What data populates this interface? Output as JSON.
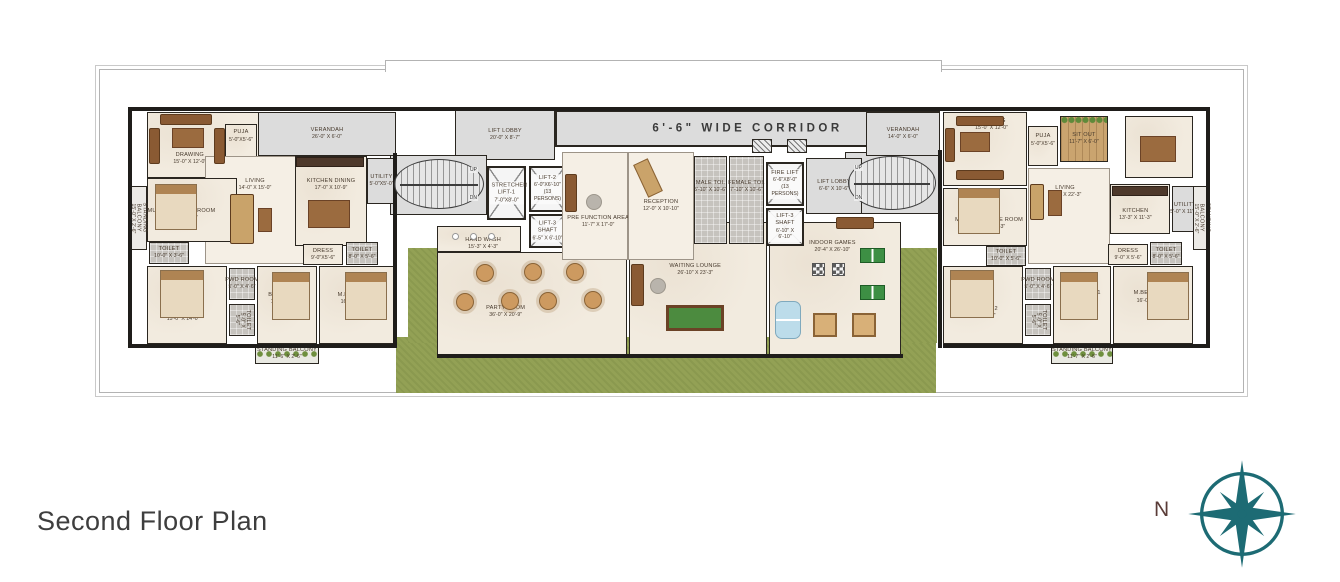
{
  "title": "Second Floor Plan",
  "compass": {
    "north_label": "N",
    "color": "#1d6b74"
  },
  "stairs": {
    "up_label": "UP",
    "dn_label": "DN"
  },
  "colors": {
    "wall": "#1f1d1a",
    "lawn": "#93a155",
    "corridor_gray": "#dcdcdc",
    "floor_beige": "#f2ebdf",
    "compass_teal": "#1d6b74"
  },
  "rooms": [
    {
      "id": "lawn-bottom",
      "x": 396,
      "y": 337,
      "w": 540,
      "h": 56,
      "cls": "lawn"
    },
    {
      "id": "lawn-left",
      "x": 408,
      "y": 248,
      "w": 32,
      "h": 95,
      "cls": "lawn"
    },
    {
      "id": "lawn-right",
      "x": 899,
      "y": 248,
      "w": 38,
      "h": 95,
      "cls": "lawn"
    },
    {
      "id": "party-room",
      "name": "PARTY ROOM",
      "dims": "36'-0\" X 20'-9\"",
      "x": 437,
      "y": 252,
      "w": 190,
      "h": 105,
      "cls": "unit",
      "lpos": [
        36,
        57
      ]
    },
    {
      "id": "waiting-lounge",
      "name": "WAITING LOUNGE",
      "dims": "26'-10\" X 23'-3\"",
      "x": 629,
      "y": 222,
      "w": 138,
      "h": 135,
      "cls": "unit",
      "lpos": [
        48,
        35
      ]
    },
    {
      "id": "indoor-games",
      "name": "INDOOR GAMES",
      "dims": "20'-4\" X 26'-10\"",
      "x": 769,
      "y": 222,
      "w": 132,
      "h": 135,
      "cls": "unit",
      "lpos": [
        48,
        18
      ]
    },
    {
      "id": "corridor",
      "name": "6'-6\" WIDE CORRIDOR",
      "x": 555,
      "y": 110,
      "w": 385,
      "h": 37,
      "cls": "gray corridor"
    },
    {
      "id": "lift-lobby-left",
      "name": "LIFT LOBBY",
      "dims": "20'-0\" X 8'-7\"",
      "x": 455,
      "y": 110,
      "w": 100,
      "h": 50,
      "cls": "gray"
    },
    {
      "id": "stair-zone-left",
      "x": 390,
      "y": 155,
      "w": 97,
      "h": 60,
      "cls": "gray"
    },
    {
      "id": "stair-zone-right",
      "x": 845,
      "y": 152,
      "w": 95,
      "h": 62,
      "cls": "gray"
    },
    {
      "id": "verandah-left",
      "name": "VERANDAH",
      "dims": "26'-0\" X 6'-0\"",
      "x": 258,
      "y": 112,
      "w": 138,
      "h": 44,
      "cls": "gray"
    },
    {
      "id": "verandah-right",
      "name": "VERANDAH",
      "dims": "14'-0\" X 6'-0\"",
      "x": 866,
      "y": 112,
      "w": 74,
      "h": 44,
      "cls": "gray"
    },
    {
      "id": "drawing-left",
      "name": "DRAWING",
      "dims": "15'-0\" X 12'-0\"",
      "x": 147,
      "y": 112,
      "w": 112,
      "h": 66,
      "cls": "unit",
      "lpos": [
        38,
        72
      ]
    },
    {
      "id": "puja-left",
      "name": "PUJA",
      "dims": "5'-0\"X5'-6\"",
      "x": 225,
      "y": 124,
      "w": 32,
      "h": 40,
      "cls": "unit",
      "lpos": [
        50,
        30
      ]
    },
    {
      "id": "living-left",
      "name": "LIVING",
      "dims": "14'-0\" X 15'-0\"",
      "x": 205,
      "y": 156,
      "w": 100,
      "h": 108,
      "cls": "open",
      "lpos": [
        50,
        26
      ]
    },
    {
      "id": "kitchen-dining-left",
      "name": "KITCHEN DINING",
      "dims": "17'-0\" X 10'-9\"",
      "x": 295,
      "y": 156,
      "w": 72,
      "h": 90,
      "cls": "unit",
      "lpos": [
        50,
        32
      ]
    },
    {
      "id": "utility-left",
      "name": "UTILITY",
      "dims": "5'-0\"X5'-0\"",
      "x": 367,
      "y": 158,
      "w": 29,
      "h": 46,
      "cls": "gray"
    },
    {
      "id": "multi-purpose-left",
      "name": "MULTI PURPOSE ROOM",
      "dims": "15'-0\" X 11'-3\"",
      "x": 147,
      "y": 178,
      "w": 90,
      "h": 64,
      "cls": "unit",
      "lpos": [
        38,
        58
      ]
    },
    {
      "id": "standing-balcony-left",
      "name": "STANDING BALCONY",
      "dims": "15'-0\" X 2'-6\"",
      "x": 130,
      "y": 186,
      "w": 17,
      "h": 64,
      "cls": "balcony",
      "vert": true
    },
    {
      "id": "toilet-left-1",
      "name": "TOILET",
      "dims": "10'-0\" X 3'-6\"",
      "x": 149,
      "y": 242,
      "w": 40,
      "h": 22,
      "cls": "tile"
    },
    {
      "id": "dress-left",
      "name": "DRESS",
      "dims": "9'-0\"X5'-6\"",
      "x": 303,
      "y": 244,
      "w": 40,
      "h": 21,
      "cls": "unit"
    },
    {
      "id": "toilet-left-2",
      "name": "TOILET",
      "dims": "8'-0\" X 5'-6\"",
      "x": 346,
      "y": 242,
      "w": 32,
      "h": 23,
      "cls": "tile"
    },
    {
      "id": "bed-room-2-left",
      "name": "BED ROOM-2",
      "dims": "15'-0\" X 14'-0\"",
      "x": 147,
      "y": 266,
      "w": 80,
      "h": 78,
      "cls": "unit",
      "lpos": [
        45,
        64
      ]
    },
    {
      "id": "pwd-room-left",
      "name": "PWD ROOM",
      "dims": "5'-0\" X 4'-6\"",
      "x": 229,
      "y": 268,
      "w": 26,
      "h": 32,
      "cls": "tile"
    },
    {
      "id": "toilet-left-3",
      "name": "TOILET",
      "dims": "5'-0\" X 5'-6\"",
      "x": 229,
      "y": 304,
      "w": 26,
      "h": 32,
      "cls": "tile",
      "vert": true
    },
    {
      "id": "bed-room-1-left",
      "name": "BED ROOM-1",
      "dims": "11'-0\" X 14'-0\"",
      "x": 257,
      "y": 266,
      "w": 60,
      "h": 78,
      "cls": "unit",
      "lpos": [
        50,
        42
      ]
    },
    {
      "id": "m-bed-room-left",
      "name": "M.BED ROOM",
      "dims": "16'-0\" X 14'-0\"",
      "x": 319,
      "y": 266,
      "w": 76,
      "h": 78,
      "cls": "unit",
      "lpos": [
        50,
        42
      ]
    },
    {
      "id": "standing-balcony-left-b",
      "name": "STANDING BALCONY",
      "dims": "11'-6\" X 2'-6\"",
      "x": 255,
      "y": 344,
      "w": 64,
      "h": 20,
      "cls": "planter"
    },
    {
      "id": "stretcher-lift-1",
      "name": "STRETCHER LIFT-1",
      "dims": "7'-0\"X8'-0\"",
      "x": 487,
      "y": 166,
      "w": 39,
      "h": 54,
      "cls": "lift"
    },
    {
      "id": "lift-2",
      "name": "LIFT-2",
      "dims": "6'-0\"X6'-10\" (13 PERSONS)",
      "x": 529,
      "y": 166,
      "w": 37,
      "h": 46,
      "cls": "lift"
    },
    {
      "id": "lift-3-shaft-center",
      "name": "LIFT-3 SHAFT",
      "dims": "6'-5\" X 6'-10\"",
      "x": 529,
      "y": 214,
      "w": 37,
      "h": 34,
      "cls": "lift"
    },
    {
      "id": "hand-wash",
      "name": "HAND WASH",
      "dims": "15'-3\" X 4'-3\"",
      "x": 437,
      "y": 226,
      "w": 84,
      "h": 26,
      "cls": "unit",
      "lpos": [
        55,
        70
      ]
    },
    {
      "id": "pre-function-area",
      "name": "PRE FUNCTION AREA",
      "dims": "11'-7\" X 17'-0\"",
      "x": 562,
      "y": 152,
      "w": 66,
      "h": 108,
      "cls": "open",
      "lpos": [
        55,
        65
      ]
    },
    {
      "id": "reception",
      "name": "RECEPTION",
      "dims": "12'-0\" X 10'-10\"",
      "x": 628,
      "y": 152,
      "w": 66,
      "h": 108,
      "cls": "open",
      "lpos": [
        50,
        50
      ]
    },
    {
      "id": "male-toilet",
      "name": "MALE TOI.",
      "dims": "5'-10\" X 10'-6\"",
      "x": 694,
      "y": 156,
      "w": 33,
      "h": 88,
      "cls": "tile",
      "lpos": [
        50,
        35
      ]
    },
    {
      "id": "female-toilet",
      "name": "FEMALE TOI.",
      "dims": "7'-10\" X 10'-6\"",
      "x": 729,
      "y": 156,
      "w": 35,
      "h": 88,
      "cls": "tile",
      "lpos": [
        50,
        35
      ]
    },
    {
      "id": "fire-lift",
      "name": "FIRE LIFT",
      "dims": "6'-6\"X8'-0\" (13 PERSONS)",
      "x": 766,
      "y": 162,
      "w": 38,
      "h": 44,
      "cls": "lift"
    },
    {
      "id": "lift-3-shaft-right",
      "name": "LIFT-3 SHAFT",
      "dims": "6'-10\" X 6'-10\"",
      "x": 766,
      "y": 208,
      "w": 38,
      "h": 38,
      "cls": "lift"
    },
    {
      "id": "lift-lobby-right",
      "name": "LIFT LOBBY",
      "dims": "6'-6\" X 10'-6\"",
      "x": 806,
      "y": 158,
      "w": 56,
      "h": 56,
      "cls": "gray"
    },
    {
      "id": "drawing-right",
      "name": "DRAWING",
      "dims": "15'-0\" X 12'-0\"",
      "x": 943,
      "y": 112,
      "w": 84,
      "h": 74,
      "cls": "unit",
      "lpos": [
        58,
        16
      ]
    },
    {
      "id": "puja-right",
      "name": "PUJA",
      "dims": "5'-0\"X5'-6\"",
      "x": 1028,
      "y": 126,
      "w": 30,
      "h": 40,
      "cls": "unit",
      "lpos": [
        50,
        35
      ]
    },
    {
      "id": "sit-out",
      "name": "SIT OUT",
      "dims": "11'-7\" X 6'-0\"",
      "x": 1060,
      "y": 116,
      "w": 48,
      "h": 46,
      "cls": "wood"
    },
    {
      "id": "living-right",
      "name": "LIVING",
      "dims": "14'-0\" X 22'-3\"",
      "x": 1028,
      "y": 168,
      "w": 82,
      "h": 96,
      "cls": "open",
      "lpos": [
        45,
        24
      ]
    },
    {
      "id": "dining-right",
      "name": "DINING",
      "dims": "10'-0\" X 12'-0\"",
      "x": 1125,
      "y": 116,
      "w": 68,
      "h": 62,
      "cls": "unit",
      "lpos": [
        50,
        58
      ]
    },
    {
      "id": "kitchen-right",
      "name": "KITCHEN",
      "dims": "13'-3\" X 11'-3\"",
      "x": 1110,
      "y": 184,
      "w": 60,
      "h": 50,
      "cls": "unit",
      "lpos": [
        42,
        62
      ]
    },
    {
      "id": "utility-right",
      "name": "UTILITY",
      "dims": "5'-0\" X 11'-3\"",
      "x": 1172,
      "y": 186,
      "w": 26,
      "h": 46,
      "cls": "gray"
    },
    {
      "id": "multi-purpose-right",
      "name": "MULTI PURPOSE ROOM",
      "dims": "15'-0\" X 11'-3\"",
      "x": 943,
      "y": 188,
      "w": 84,
      "h": 58,
      "cls": "unit",
      "lpos": [
        55,
        62
      ]
    },
    {
      "id": "toilet-right-1",
      "name": "TOILET",
      "dims": "10'-0\" X 5'-6\"",
      "x": 986,
      "y": 246,
      "w": 40,
      "h": 20,
      "cls": "tile"
    },
    {
      "id": "dress-right",
      "name": "DRESS",
      "dims": "9'-0\" X 5'-6\"",
      "x": 1108,
      "y": 244,
      "w": 40,
      "h": 21,
      "cls": "unit"
    },
    {
      "id": "toilet-right-2",
      "name": "TOILET",
      "dims": "8'-0\" X 5'-6\"",
      "x": 1150,
      "y": 242,
      "w": 32,
      "h": 23,
      "cls": "tile"
    },
    {
      "id": "bed-room-2-right",
      "name": "BED ROOM-2",
      "dims": "15'-0\" X 14'-0\"",
      "x": 943,
      "y": 266,
      "w": 80,
      "h": 78,
      "cls": "unit",
      "lpos": [
        45,
        60
      ]
    },
    {
      "id": "pwd-room-right",
      "name": "PWD ROOM",
      "dims": "5'-0\" X 4'-6\"",
      "x": 1025,
      "y": 268,
      "w": 26,
      "h": 32,
      "cls": "tile"
    },
    {
      "id": "toilet-right-3",
      "name": "TOILET",
      "dims": "5'-0\" X 5'-6\"",
      "x": 1025,
      "y": 304,
      "w": 26,
      "h": 32,
      "cls": "tile",
      "vert": true
    },
    {
      "id": "bed-room-1-right",
      "name": "BED ROOM-1",
      "dims": "11'-0\" X 14'-0\"",
      "x": 1053,
      "y": 266,
      "w": 58,
      "h": 78,
      "cls": "unit",
      "lpos": [
        50,
        40
      ]
    },
    {
      "id": "m-bed-room-right",
      "name": "M.BED ROOM",
      "dims": "16'-0\" X 14'-0\"",
      "x": 1113,
      "y": 266,
      "w": 80,
      "h": 78,
      "cls": "unit",
      "lpos": [
        50,
        40
      ]
    },
    {
      "id": "standing-balcony-right",
      "name": "STANDING BALCONY",
      "dims": "11'-7\" X 2'-6\"",
      "x": 1051,
      "y": 344,
      "w": 62,
      "h": 20,
      "cls": "planter"
    },
    {
      "id": "standing-balcony-right-edge",
      "name": "STANDING BALCONY",
      "dims": "15'-0\" X 2'-6\"",
      "x": 1193,
      "y": 186,
      "w": 17,
      "h": 64,
      "cls": "balcony",
      "vert": true
    }
  ]
}
